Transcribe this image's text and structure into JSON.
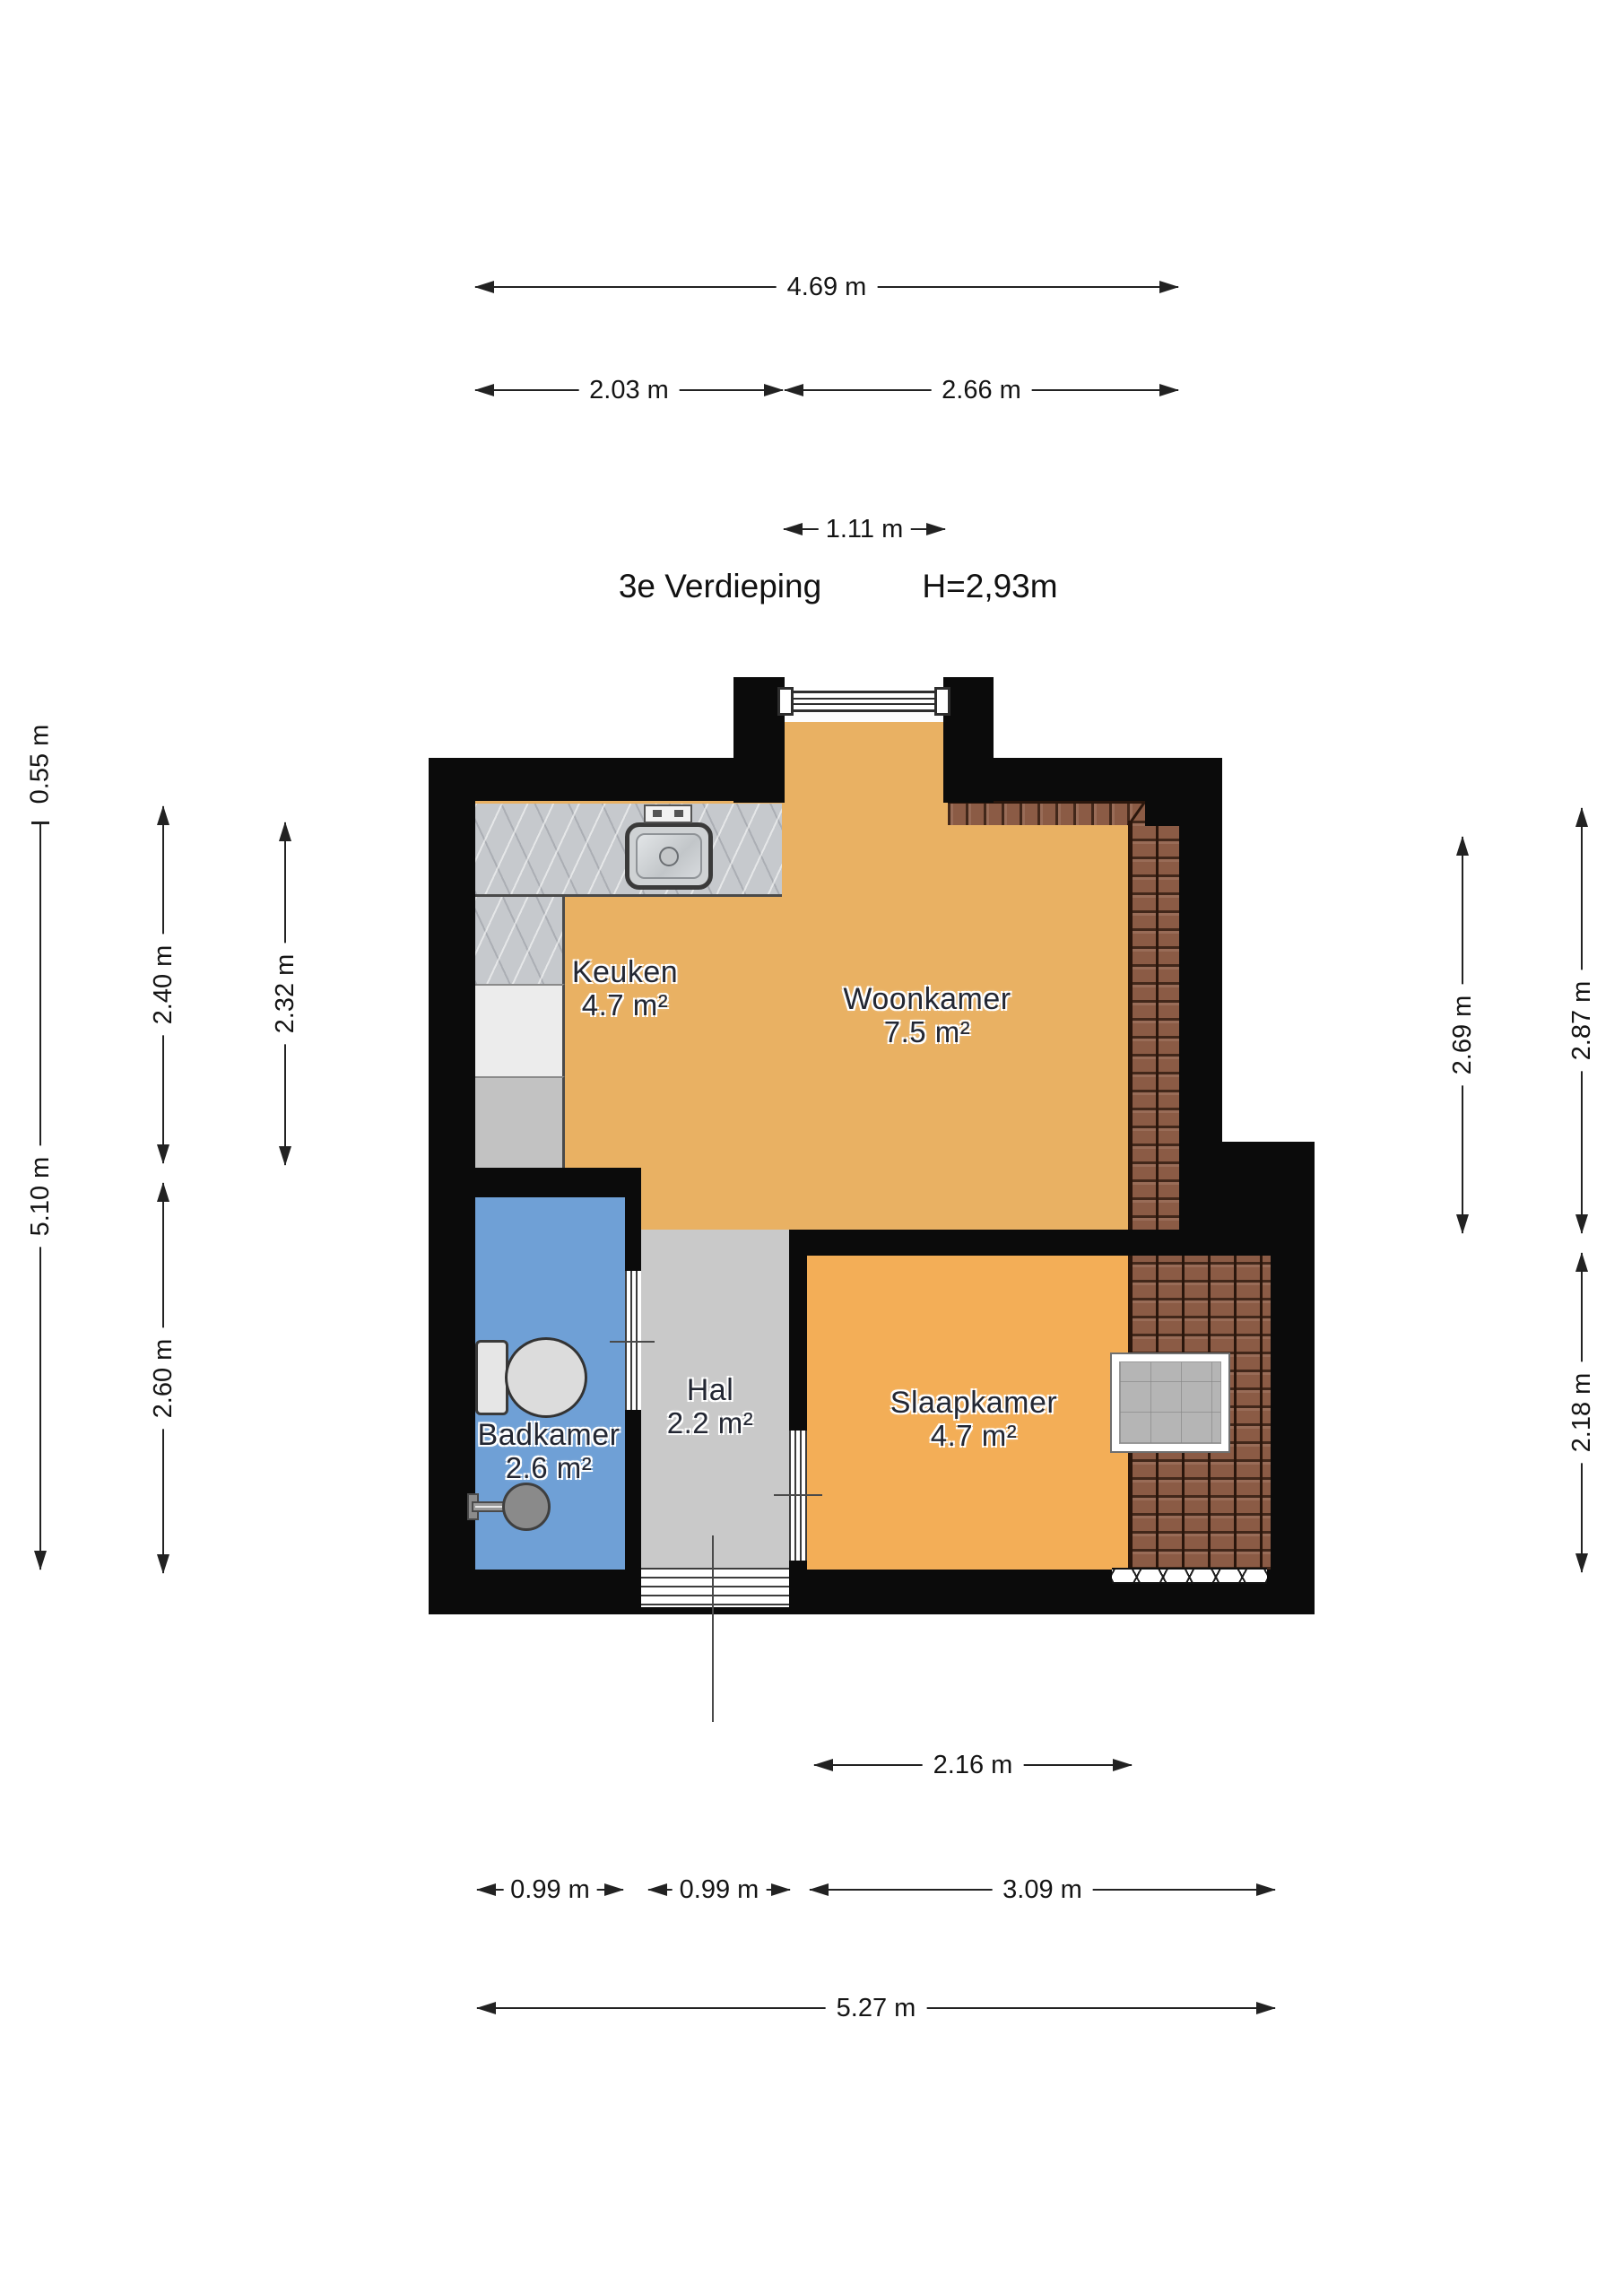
{
  "header": {
    "floor_label": "3e Verdieping",
    "ceiling_height": "H=2,93m"
  },
  "rooms": [
    {
      "name": "Keuken",
      "area": "4.7 m²"
    },
    {
      "name": "Woonkamer",
      "area": "7.5 m²"
    },
    {
      "name": "Badkamer",
      "area": "2.6 m²"
    },
    {
      "name": "Hal",
      "area": "2.2 m²"
    },
    {
      "name": "Slaapkamer",
      "area": "4.7 m²"
    }
  ],
  "dimensions": {
    "top_width_total": "4.69 m",
    "top_width_left": "2.03 m",
    "top_width_right": "2.66 m",
    "dormer_width": "1.11 m",
    "left_offset": "0.55 m",
    "left_height_total": "5.10 m",
    "keuken_depth": "2.40 m",
    "keuken_depth_inner": "2.32 m",
    "badkamer_depth": "2.60 m",
    "right_depth_inner": "2.69 m",
    "right_depth_outer": "2.87 m",
    "slaapkamer_depth": "2.18 m",
    "slaapkamer_width": "2.16 m",
    "badkamer_width": "0.99 m",
    "hal_width": "0.99 m",
    "bottom_width_right": "3.09 m",
    "bottom_width_total": "5.27 m"
  },
  "fixtures": {
    "sink": "kitchen-sink",
    "faucet": "faucet",
    "toilet": "toilet",
    "shower": "shower-head",
    "skylight": "roof-window",
    "dormer_window": "window",
    "roof_texture": "sloped-roof-tiles",
    "entrance_door": "front-door"
  },
  "colors": {
    "wall": "#0b0b0b",
    "floor_orange": "#e9b163",
    "floor_orange_bright": "#f3ae57",
    "floor_gray": "#c9c9c9",
    "floor_blue": "#6fa0d6",
    "tile_brown": "#8b5b45",
    "tile_dark": "#2a160c",
    "counter_marble": "#c6c9cd",
    "dim_line": "#222222",
    "room_text": "#232733",
    "skylight_gray": "#b5b5b5"
  }
}
